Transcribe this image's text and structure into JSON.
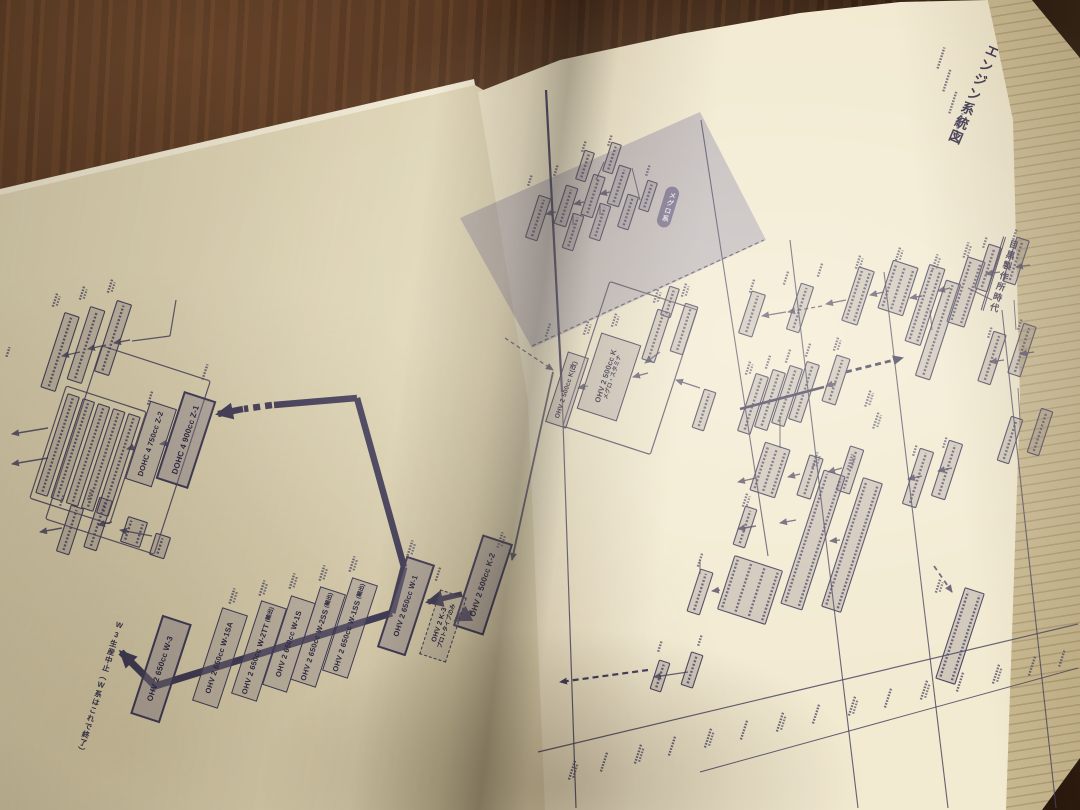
{
  "page": {
    "title": "エンジン系統図",
    "era_heading": "目黒製作所時代",
    "era_badge": "メグロ系"
  },
  "boxes": {
    "z1": "DOHC 4 900cc Z-1",
    "z2": "DOHC 4 750cc Z-2",
    "w1": "OHV 2 650cc W-1",
    "w1ss": "OHV 2 650cc W-1SS",
    "w1ss_note": "(輸出)",
    "w2ss": "OHV 2 650cc W-2SS",
    "w2ss_note": "(輸出)",
    "w1s": "OHV 2 650cc W-1S",
    "w2tt": "OHV 2 650cc W-2TT",
    "w2tt_note": "(輸出)",
    "w1sa": "OHV 2 650cc W-1SA",
    "w3": "OHV 2 650cc W-3",
    "k": "OHV 2 500cc K",
    "k_note": "メグロ・スタミナ",
    "k_kai": "OHV 2 500cc K(改)",
    "k2": "OHV 2 500cc K-2",
    "k3": "OHV 2 K-3",
    "k3_note": "プロトタイプのみ"
  },
  "notes": {
    "w3_end": "W3生産中止（W系はこれで終了）"
  },
  "colors": {
    "ink": "#46415e",
    "paper_left": "#e4dabb",
    "paper_right": "#f2ead1",
    "lavender": "#aaa2c4",
    "badge_bg": "#7b7390",
    "wood": "#4a2f1d"
  }
}
